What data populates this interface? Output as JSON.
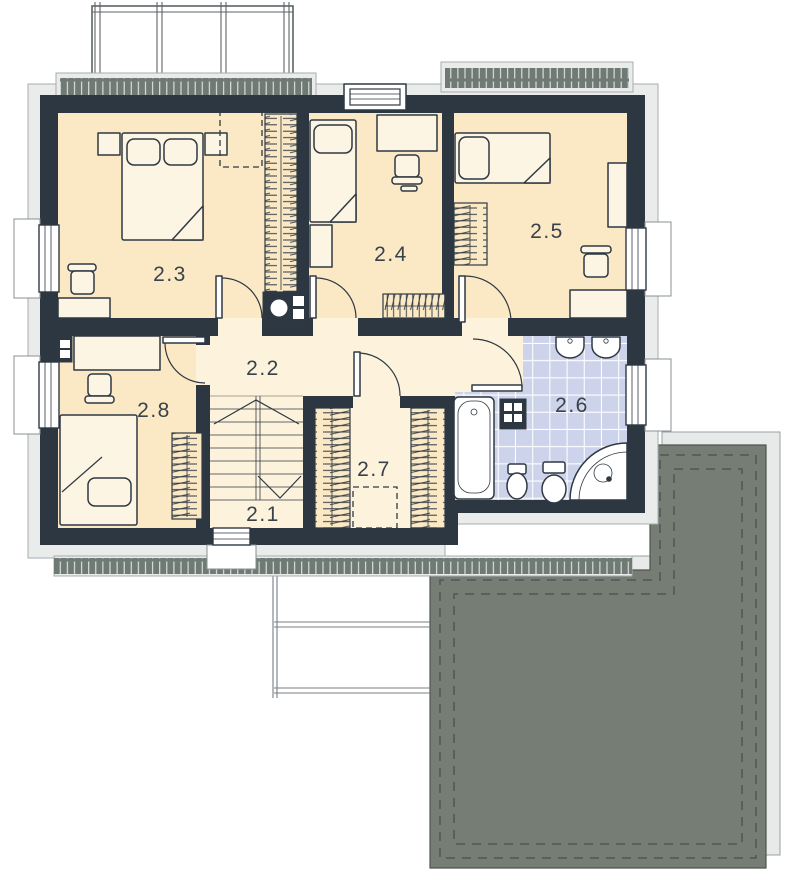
{
  "plan": {
    "drawing_type": "upper-floor-plan",
    "rooms": [
      {
        "label": "2.1",
        "type": "staircase"
      },
      {
        "label": "2.2",
        "type": "hallway"
      },
      {
        "label": "2.3",
        "type": "bedroom-double"
      },
      {
        "label": "2.4",
        "type": "bedroom-single"
      },
      {
        "label": "2.5",
        "type": "bedroom-single"
      },
      {
        "label": "2.6",
        "type": "bathroom"
      },
      {
        "label": "2.7",
        "type": "walk-in-closet"
      },
      {
        "label": "2.8",
        "type": "bedroom-single"
      }
    ],
    "colors": {
      "wall": "#2d3742",
      "floor": "#fbe9c5",
      "hall": "#fdf3dd",
      "tile": "#cdd3ea",
      "roof": "#757d74",
      "sheet": "#e8eaea",
      "eave": "#eaecec",
      "hatch": "#6f7a74",
      "furniture": "#fdf5e3",
      "label": "#39414b"
    }
  }
}
